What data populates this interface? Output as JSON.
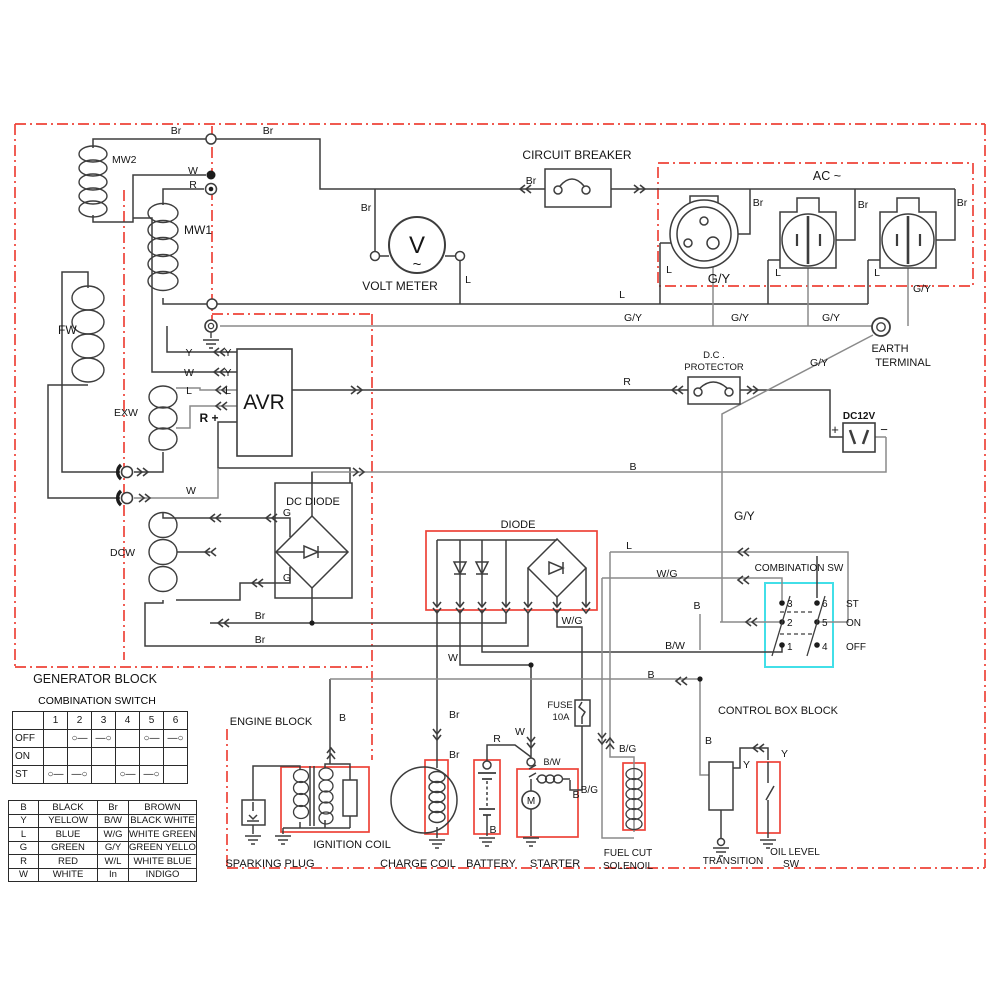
{
  "blocks": {
    "generator_block": "GENERATOR BLOCK",
    "engine_block": "ENGINE BLOCK",
    "control_box_block": "CONTROL BOX BLOCK"
  },
  "components": {
    "mw2": "MW2",
    "mw1": "MW1",
    "fw": "FW",
    "exw": "EXW",
    "dcw": "DCW",
    "avr": "AVR",
    "volt_meter": "VOLT METER",
    "volt_symbol": "V",
    "volt_wave": "~",
    "circuit_breaker": "CIRCUIT BREAKER",
    "ac_label": "AC ~",
    "earth_terminal_line1": "EARTH",
    "earth_terminal_line2": "TERMINAL",
    "dc_protector_line1": "D.C .",
    "dc_protector_line2": "PROTECTOR",
    "dc12v": "DC12V",
    "dc_diode": "DC DIODE",
    "diode": "DIODE",
    "combination_sw": "COMBINATION SW",
    "fuse_line1": "FUSE",
    "fuse_line2": "10A",
    "sparking_plug": "SPARKING PLUG",
    "ignition_coil": "IGNITION COIL",
    "charge_coil": "CHARGE COIL",
    "battery": "BATTERY",
    "starter": "STARTER",
    "motor_m": "M",
    "fuel_cut_line1": "FUEL CUT",
    "fuel_cut_line2": "SOLENOIL",
    "transition": "TRANSITION",
    "oil_level_line1": "OIL LEVEL",
    "oil_level_line2": "SW"
  },
  "wire_labels": {
    "br": "Br",
    "w": "W",
    "r": "R",
    "l": "L",
    "y": "Y",
    "g": "G",
    "b": "B",
    "gy": "G/Y",
    "wg": "W/G",
    "bw": "B/W",
    "bg": "B/G",
    "r_plus": "R +",
    "plus": "+",
    "minus": "−"
  },
  "combination_sw_panel": {
    "contacts": [
      "1",
      "2",
      "3",
      "4",
      "5",
      "6"
    ],
    "positions": {
      "st": "ST",
      "on": "ON",
      "off": "OFF"
    }
  },
  "combination_switch_table": {
    "title": "COMBINATION SWITCH",
    "grid": [
      [
        "",
        "1",
        "2",
        "3",
        "4",
        "5",
        "6"
      ],
      [
        "OFF",
        "",
        "○—",
        "—○",
        "",
        "○—",
        "—○"
      ],
      [
        "ON",
        "",
        "",
        "",
        "",
        "",
        ""
      ],
      [
        "ST",
        "○—",
        "—○",
        "",
        "○—",
        "—○",
        ""
      ]
    ]
  },
  "color_code_table": {
    "rows": [
      [
        "B",
        "BLACK",
        "Br",
        "BROWN"
      ],
      [
        "Y",
        "YELLOW",
        "B/W",
        "BLACK  WHITE"
      ],
      [
        "L",
        "BLUE",
        "W/G",
        "WHITE GREEN"
      ],
      [
        "G",
        "GREEN",
        "G/Y",
        "GREEN YELLOW"
      ],
      [
        "R",
        "RED",
        "W/L",
        "WHITE BLUE"
      ],
      [
        "W",
        "WHITE",
        "In",
        "INDIGO"
      ]
    ]
  },
  "colors": {
    "boundary_red": "#ee4338",
    "highlight_cyan": "#42dfe8",
    "wire_dark": "#3d3d3d",
    "wire_gray": "#8a8a8a"
  }
}
